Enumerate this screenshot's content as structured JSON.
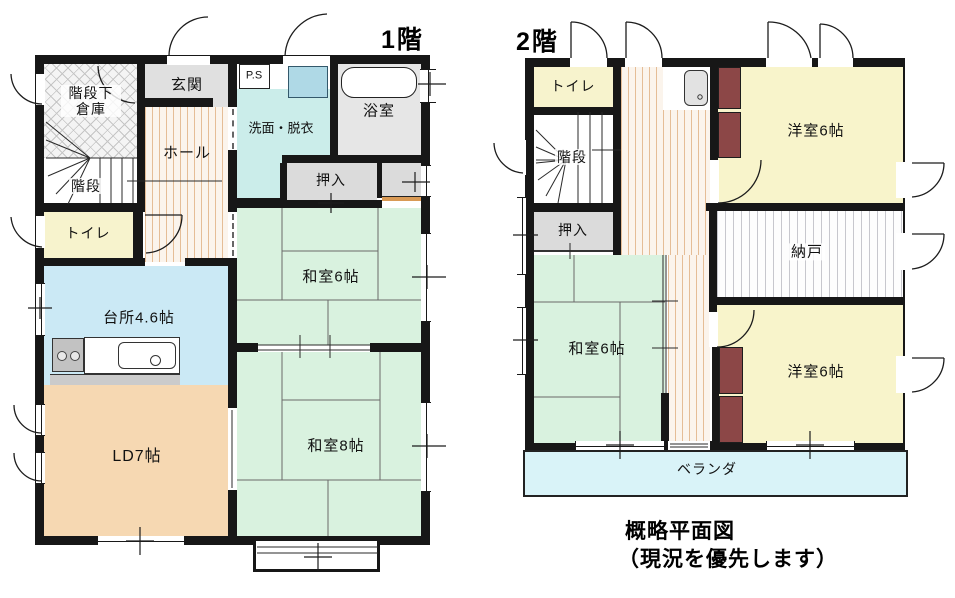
{
  "floor1": {
    "title": "1階",
    "rooms": {
      "storage_under_stairs": "階段下倉庫",
      "stairs": "階段",
      "genkan": "玄関",
      "ps": "P.S",
      "washroom": "洗面・脱衣",
      "bathroom": "浴室",
      "hall": "ホール",
      "toilet": "トイレ",
      "closet": "押入",
      "washitsu6": "和室6帖",
      "kitchen": "台所4.6帖",
      "ld": "LD7帖",
      "washitsu8": "和室8帖"
    }
  },
  "floor2": {
    "title": "2階",
    "rooms": {
      "toilet": "トイレ",
      "stairs": "階段",
      "closet": "押入",
      "western6_top": "洋室6帖",
      "nando": "納戸",
      "washitsu6": "和室6帖",
      "western6_bottom": "洋室6帖",
      "veranda": "ベランダ"
    }
  },
  "caption": {
    "line1": "概略平面図",
    "line2": "（現況を優先します）"
  },
  "colors": {
    "wall": "#171717",
    "tatami_green": "#d9f2df",
    "western_yellow": "#f8f4cb",
    "toilet_yellow": "#f7f3cd",
    "kitchen_blue": "#cbe9f5",
    "washroom_cyan": "#cbedea",
    "ld_peach": "#f6d8b2",
    "veranda_cyan": "#d9f3f8",
    "closet_gray": "#dbdbdb",
    "genkan_gray": "#e0e0e0",
    "bathroom_gray": "#e6e6e6",
    "maroon_closet": "#8c4747",
    "wood_stripe": "#e5bd96",
    "sink_blue": "#afd9e6"
  }
}
